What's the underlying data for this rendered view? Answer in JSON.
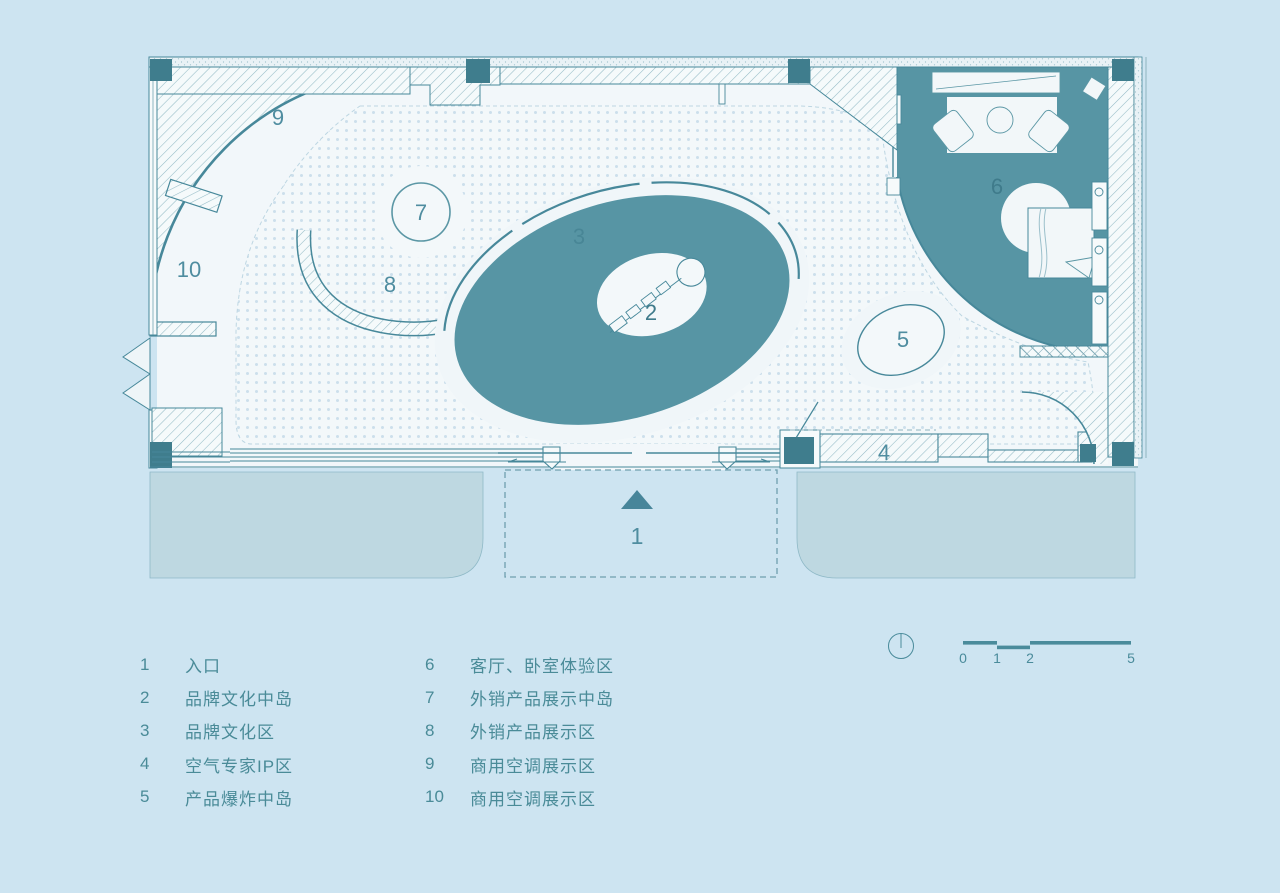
{
  "title": "showroom-floor-plan",
  "plan": {
    "areas": [
      {
        "num": "1",
        "label": "入口"
      },
      {
        "num": "2",
        "label": "品牌文化中岛"
      },
      {
        "num": "3",
        "label": "品牌文化区"
      },
      {
        "num": "4",
        "label": "空气专家IP区"
      },
      {
        "num": "5",
        "label": "产品爆炸中岛"
      },
      {
        "num": "6",
        "label": "客厅、卧室体验区"
      },
      {
        "num": "7",
        "label": "外销产品展示中岛"
      },
      {
        "num": "8",
        "label": "外销产品展示区"
      },
      {
        "num": "9",
        "label": "商用空调展示区"
      },
      {
        "num": "10",
        "label": "商用空调展示区"
      }
    ],
    "compass": "north-indicator"
  },
  "scalebar": {
    "ticks": [
      "0",
      "1",
      "2",
      "5"
    ]
  },
  "colors": {
    "background": "#cde4f1",
    "teal_fill": "#5795a4",
    "teal_dark": "#3f7d8d",
    "line": "#47889a",
    "floor": "#f2f7fa",
    "exterior_paving": "#bed8e1",
    "label_text": "#4f8da0",
    "legend_text": "#4a8b98"
  }
}
